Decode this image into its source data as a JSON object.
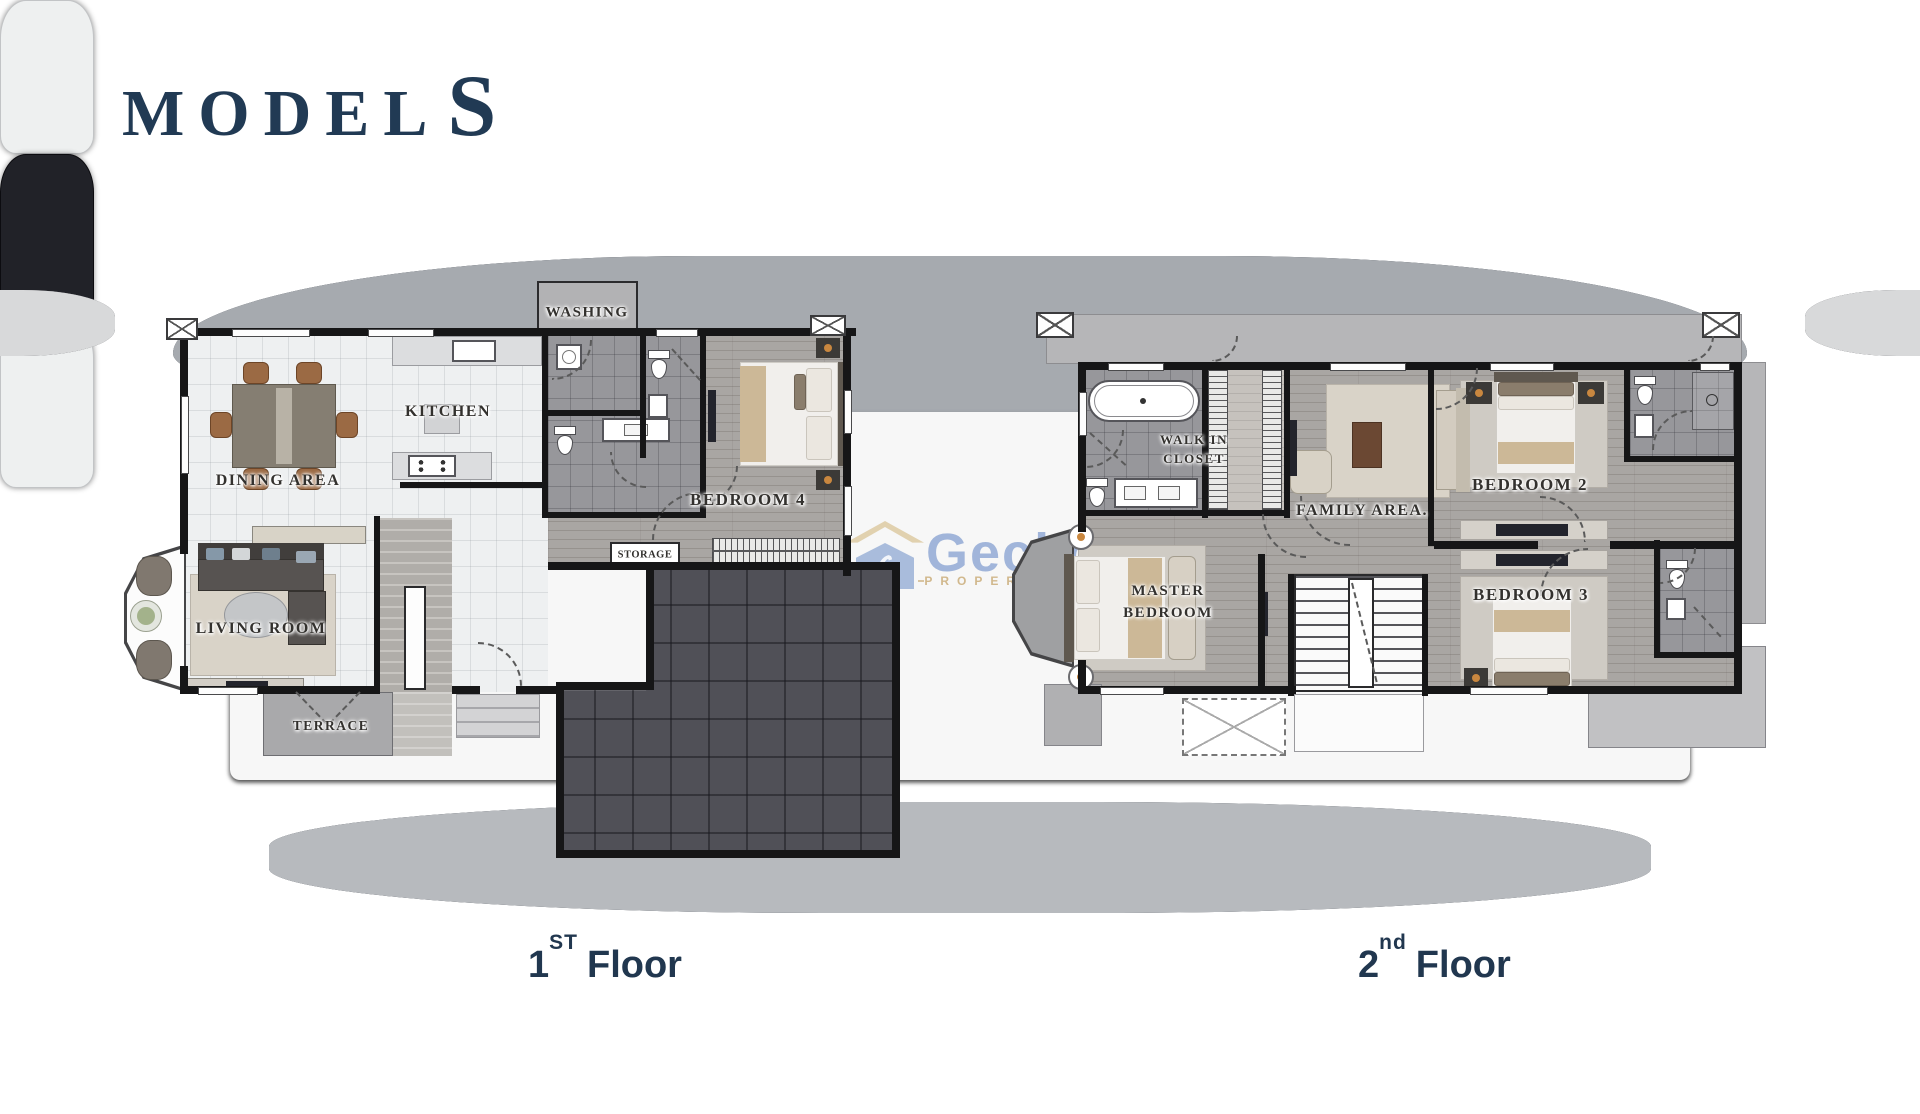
{
  "page": {
    "title_main": "MODEL",
    "title_suffix": "S"
  },
  "colors": {
    "navy": "#213a54",
    "caption_navy": "#21374f",
    "watermark_blue": "#6285c4",
    "watermark_beige": "#c4a369",
    "wall": "#161617",
    "wood_floor": "#a9a6a3",
    "tile_floor": "#eef0f1",
    "garage_floor": "#505057"
  },
  "watermark": {
    "brand": "Gecko",
    "tagline": "PROPERTIES"
  },
  "floor1": {
    "caption": {
      "number": "1",
      "ordinal": "ST",
      "word": "Floor"
    },
    "rooms": {
      "washing": "WASHING",
      "kitchen": "KITCHEN",
      "dining": "DINING AREA",
      "living": "LIVING ROOM",
      "terrace": "TERRACE",
      "bedroom4": "BEDROOM 4",
      "storage": "STORAGE"
    }
  },
  "floor2": {
    "caption": {
      "number": "2",
      "ordinal": "nd",
      "word": "Floor"
    },
    "rooms": {
      "walkin_line1": "WALK IN",
      "walkin_line2": "CLOSET",
      "family": "FAMILY AREA.",
      "master_line1": "MASTER",
      "master_line2": "BEDROOM",
      "bedroom2": "BEDROOM 2",
      "bedroom3": "BEDROOM 3"
    }
  }
}
